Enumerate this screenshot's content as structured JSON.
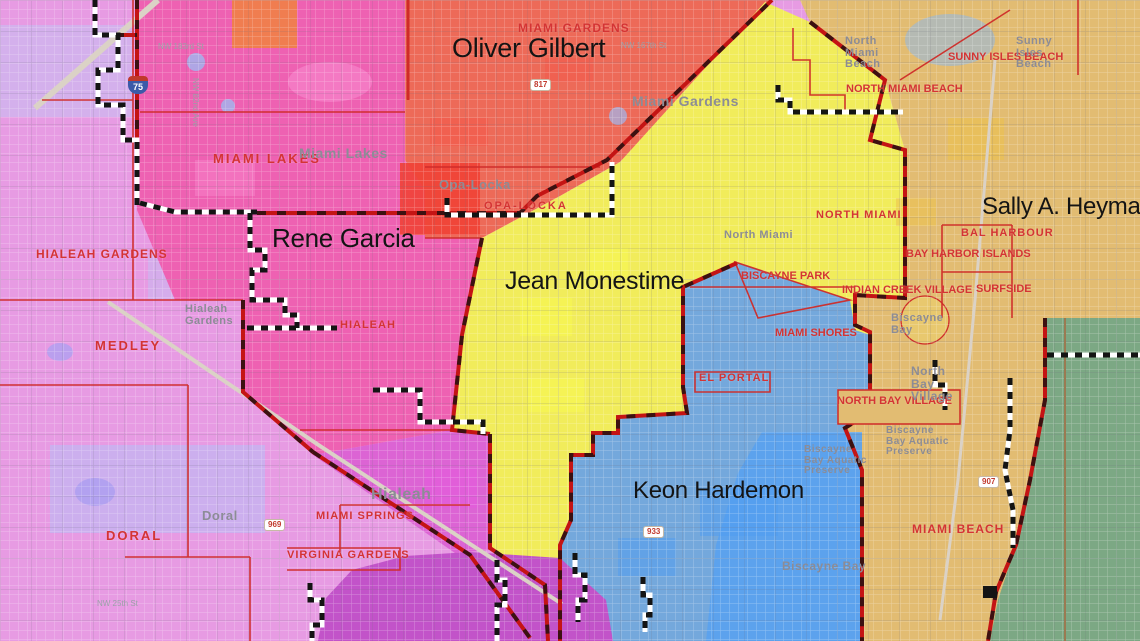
{
  "map_type": "county-commission-district-map",
  "districts": [
    {
      "commissioner": "Oliver Gilbert",
      "color": "#ED6A58"
    },
    {
      "commissioner": "Rene Garcia",
      "color": "#EE61B2"
    },
    {
      "commissioner": "Jean Monestime",
      "color": "#F1EC5B"
    },
    {
      "commissioner": "Keon Hardemon",
      "color": "#74A8DC"
    },
    {
      "commissioner": "Sally A. Heyman",
      "color": "#E2BC72"
    }
  ],
  "colors": {
    "base": "#E79BE3",
    "water": "#5AA2EE",
    "green": "#7CA884",
    "purple": "#C253C9",
    "magenta": "#DC64D4",
    "boundary_red": "#C41414",
    "municipal_red": "#CF2B28",
    "city_label": "#D43434",
    "basemap_label": "#8C8C96"
  },
  "commissioner_labels": [
    {
      "text": "Oliver Gilbert",
      "x": 452,
      "y": 34,
      "fs": 27
    },
    {
      "text": "Rene Garcia",
      "x": 272,
      "y": 225,
      "fs": 26
    },
    {
      "text": "Jean Monestime",
      "x": 505,
      "y": 268,
      "fs": 25
    },
    {
      "text": "Keon Hardemon",
      "x": 633,
      "y": 478,
      "fs": 24
    },
    {
      "text": "Sally A. Heyman",
      "x": 982,
      "y": 194,
      "fs": 24
    }
  ],
  "city_labels": [
    {
      "text": "MIAMI GARDENS",
      "x": 518,
      "y": 22,
      "fs": 12,
      "ls": 1
    },
    {
      "text": "MIAMI LAKES",
      "x": 213,
      "y": 152,
      "fs": 13,
      "ls": 2
    },
    {
      "text": "HIALEAH GARDENS",
      "x": 36,
      "y": 248,
      "fs": 12,
      "ls": 1
    },
    {
      "text": "MEDLEY",
      "x": 95,
      "y": 339,
      "fs": 13,
      "ls": 2
    },
    {
      "text": "HIALEAH",
      "x": 340,
      "y": 320,
      "fs": 11,
      "ls": 1
    },
    {
      "text": "DORAL",
      "x": 106,
      "y": 529,
      "fs": 13,
      "ls": 2
    },
    {
      "text": "MIAMI SPRINGS",
      "x": 316,
      "y": 511,
      "fs": 11,
      "ls": 1
    },
    {
      "text": "VIRGINIA GARDENS",
      "x": 287,
      "y": 550,
      "fs": 11,
      "ls": 1
    },
    {
      "text": "OPA-LOCKA",
      "x": 484,
      "y": 201,
      "fs": 11,
      "ls": 2
    },
    {
      "text": "NORTH MIAMI BEACH",
      "x": 846,
      "y": 84,
      "fs": 11,
      "ls": 0
    },
    {
      "text": "SUNNY ISLES BEACH",
      "x": 948,
      "y": 52,
      "fs": 11,
      "ls": 0
    },
    {
      "text": "NORTH MIAMI",
      "x": 816,
      "y": 210,
      "fs": 11,
      "ls": 1
    },
    {
      "text": "BISCAYNE PARK",
      "x": 741,
      "y": 271,
      "fs": 11,
      "ls": 0
    },
    {
      "text": "MIAMI SHORES",
      "x": 775,
      "y": 328,
      "fs": 11,
      "ls": 0
    },
    {
      "text": "EL PORTAL",
      "x": 699,
      "y": 373,
      "fs": 11,
      "ls": 1
    },
    {
      "text": "NORTH BAY VILLAGE",
      "x": 837,
      "y": 396,
      "fs": 11,
      "ls": 0
    },
    {
      "text": "BAL HARBOUR",
      "x": 961,
      "y": 228,
      "fs": 11,
      "ls": 1
    },
    {
      "text": "BAY HARBOR ISLANDS",
      "x": 906,
      "y": 249,
      "fs": 11,
      "ls": 0
    },
    {
      "text": "INDIAN CREEK VILLAGE",
      "x": 842,
      "y": 285,
      "fs": 11,
      "ls": 0
    },
    {
      "text": "SURFSIDE",
      "x": 976,
      "y": 284,
      "fs": 11,
      "ls": 0
    },
    {
      "text": "MIAMI BEACH",
      "x": 912,
      "y": 523,
      "fs": 12,
      "ls": 1
    }
  ],
  "basemap_labels": [
    {
      "text": "Miami Lakes",
      "x": 299,
      "y": 146,
      "fs": 14
    },
    {
      "text": "Miami Gardens",
      "x": 632,
      "y": 94,
      "fs": 14
    },
    {
      "text": "Opa-Locka",
      "x": 439,
      "y": 178,
      "fs": 13
    },
    {
      "text": "North\nMiami\nBeach",
      "x": 845,
      "y": 36,
      "fs": 11
    },
    {
      "text": "Sunny\nIsles\nBeach",
      "x": 1016,
      "y": 36,
      "fs": 11
    },
    {
      "text": "North Miami",
      "x": 724,
      "y": 230,
      "fs": 11
    },
    {
      "text": "Hialeah\nGardens",
      "x": 185,
      "y": 304,
      "fs": 11
    },
    {
      "text": "Hialeah",
      "x": 371,
      "y": 487,
      "fs": 16
    },
    {
      "text": "Doral",
      "x": 202,
      "y": 509,
      "fs": 13
    },
    {
      "text": "Biscayne\nBay",
      "x": 891,
      "y": 313,
      "fs": 11
    },
    {
      "text": "North\nBay\nVillage",
      "x": 911,
      "y": 365,
      "fs": 12
    },
    {
      "text": "Biscayne\nBay Aquatic\nPreserve",
      "x": 804,
      "y": 445,
      "fs": 10
    },
    {
      "text": "Biscayne\nBay Aquatic\nPreserve",
      "x": 886,
      "y": 426,
      "fs": 10
    },
    {
      "text": "Biscayne Bay",
      "x": 782,
      "y": 560,
      "fs": 12
    }
  ],
  "street_labels": [
    {
      "text": "NW 183rd St",
      "x": 158,
      "y": 43,
      "fs": 8
    },
    {
      "text": "NW 167th St",
      "x": 621,
      "y": 42,
      "fs": 8
    },
    {
      "text": "NW 82nd Ave",
      "x": 199,
      "y": 78,
      "fs": 8,
      "vert": true
    },
    {
      "text": "NW 25th St",
      "x": 97,
      "y": 600,
      "fs": 8
    }
  ],
  "route_shields": [
    {
      "text": "75",
      "kind": "interstate",
      "x": 128,
      "y": 76
    },
    {
      "text": "817",
      "kind": "state",
      "x": 530,
      "y": 79
    },
    {
      "text": "969",
      "kind": "state",
      "x": 264,
      "y": 519
    },
    {
      "text": "907",
      "kind": "state",
      "x": 978,
      "y": 476
    },
    {
      "text": "933",
      "kind": "state",
      "x": 643,
      "y": 526
    }
  ]
}
